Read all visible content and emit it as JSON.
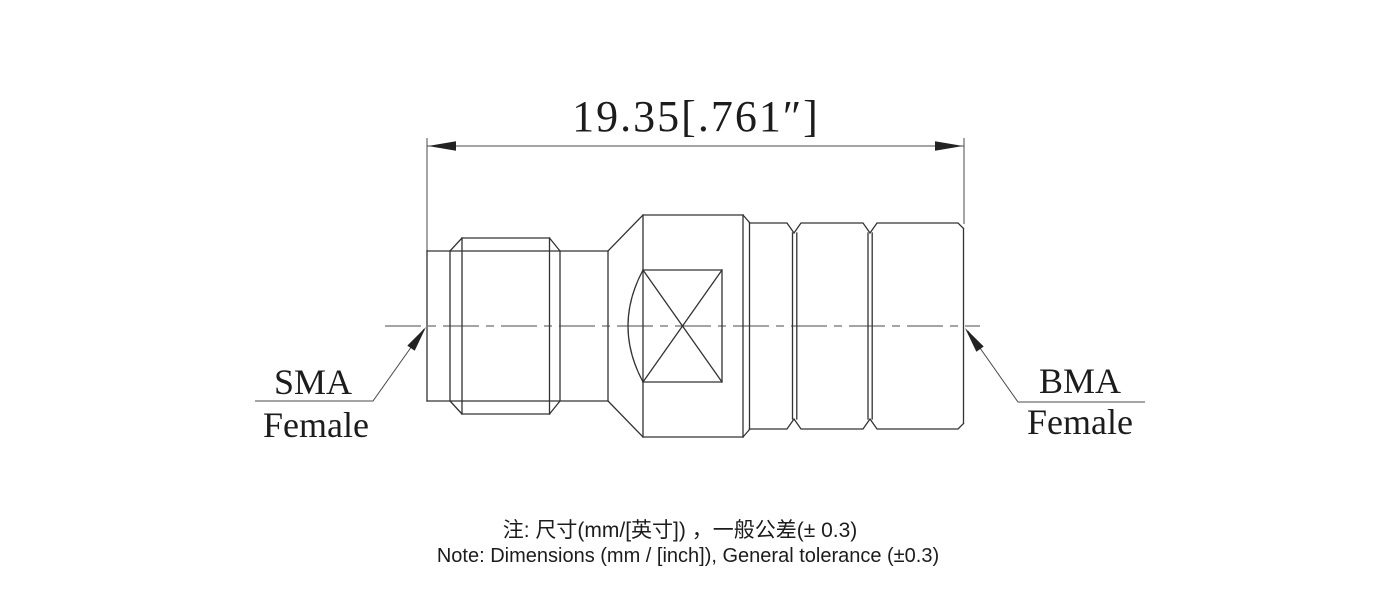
{
  "drawing": {
    "dimension_label": "19.35[.761″]",
    "left_connector": {
      "line1": "SMA",
      "line2": "Female"
    },
    "right_connector": {
      "line1": "BMA",
      "line2": "Female"
    },
    "notes": {
      "chinese": "注: 尺寸(mm/[英寸]) ，一般公差(± 0.3)",
      "english": "Note: Dimensions (mm / [inch]), General tolerance (±0.3)"
    },
    "colors": {
      "outline": "#333333",
      "thin_line": "#4a4a4a",
      "arrow": "#222222",
      "text": "#1c1c1c",
      "background": "#ffffff"
    }
  }
}
